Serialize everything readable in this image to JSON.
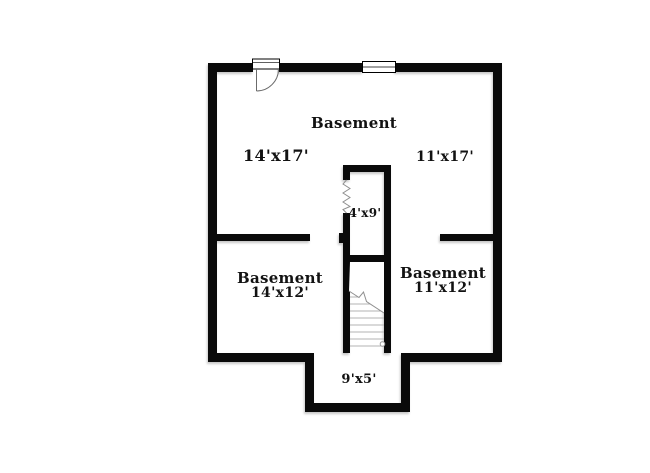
{
  "floorplan": {
    "type": "basement floor plan",
    "colors": {
      "wall": "#0a0a0a",
      "floor": "#ffffff",
      "detail_line": "#8f8f8f",
      "stair_tread": "#b3b3b3"
    },
    "upper_room": {
      "name": "Basement",
      "left_dim": "14'x17'",
      "right_dim": "11'x17'"
    },
    "closet": {
      "dim": "4'x9'"
    },
    "lower_left_room": {
      "name": "Basement",
      "dim": "14'x12'"
    },
    "lower_right_room": {
      "name": "Basement",
      "dim": "11'x12'"
    },
    "bump_out": {
      "dim": "9'x5'"
    }
  }
}
